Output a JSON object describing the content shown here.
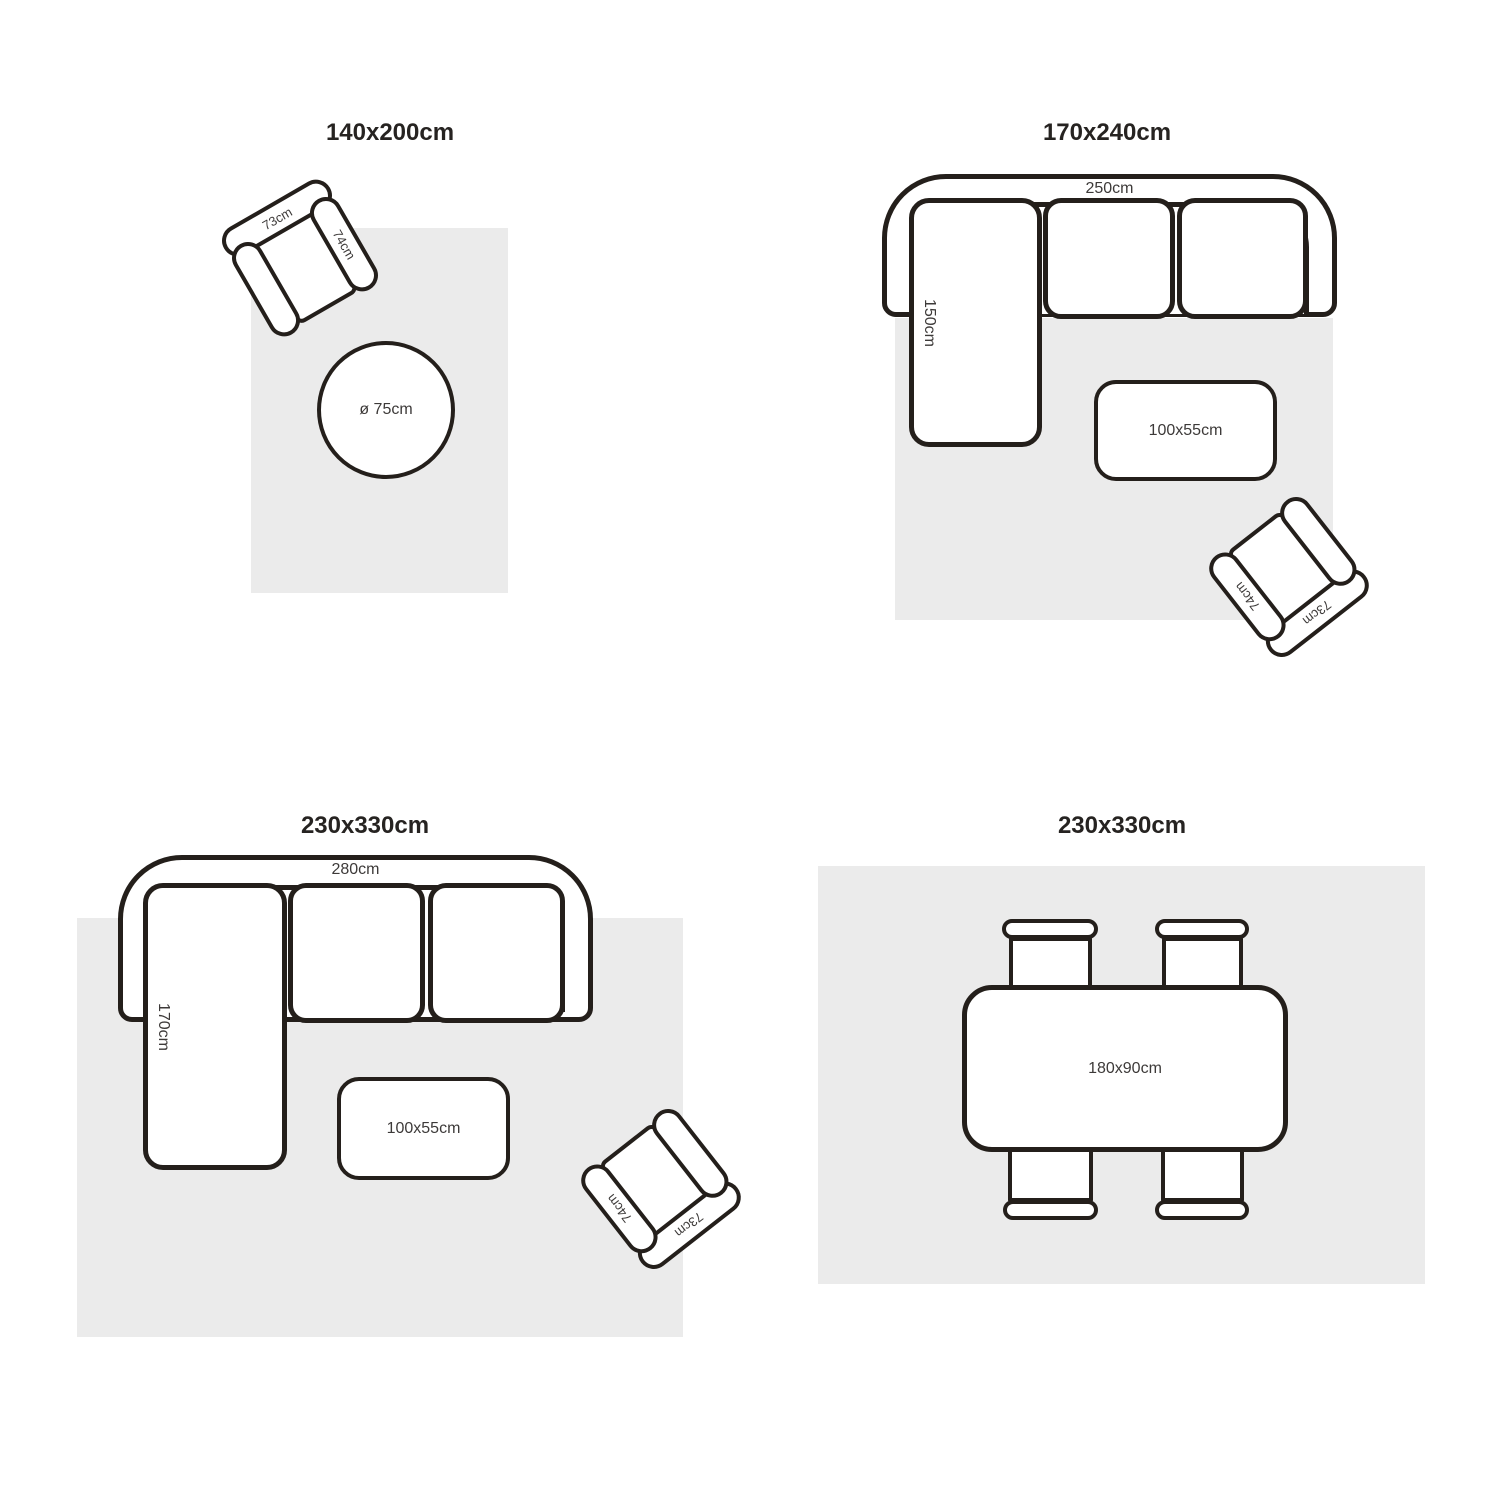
{
  "colors": {
    "outline": "#241f1b",
    "rug": "#ebebeb",
    "label": "#3d3a39",
    "title": "#262321",
    "canvas": "#ffffff"
  },
  "quadrants": [
    {
      "title": "140x200cm",
      "armchair": {
        "back_label": "73cm",
        "arm_label": "74cm"
      },
      "round_table": {
        "label": "ø 75cm"
      }
    },
    {
      "title": "170x240cm",
      "sofa": {
        "width_label": "250cm",
        "chaise_label": "150cm"
      },
      "coffee_table": {
        "label": "100x55cm"
      },
      "armchair": {
        "back_label": "73cm",
        "arm_label": "74cm"
      }
    },
    {
      "title": "230x330cm",
      "sofa": {
        "width_label": "280cm",
        "chaise_label": "170cm"
      },
      "coffee_table": {
        "label": "100x55cm"
      },
      "armchair": {
        "back_label": "73cm",
        "arm_label": "74cm"
      }
    },
    {
      "title": "230x330cm",
      "dining_table": {
        "label": "180x90cm"
      }
    }
  ]
}
